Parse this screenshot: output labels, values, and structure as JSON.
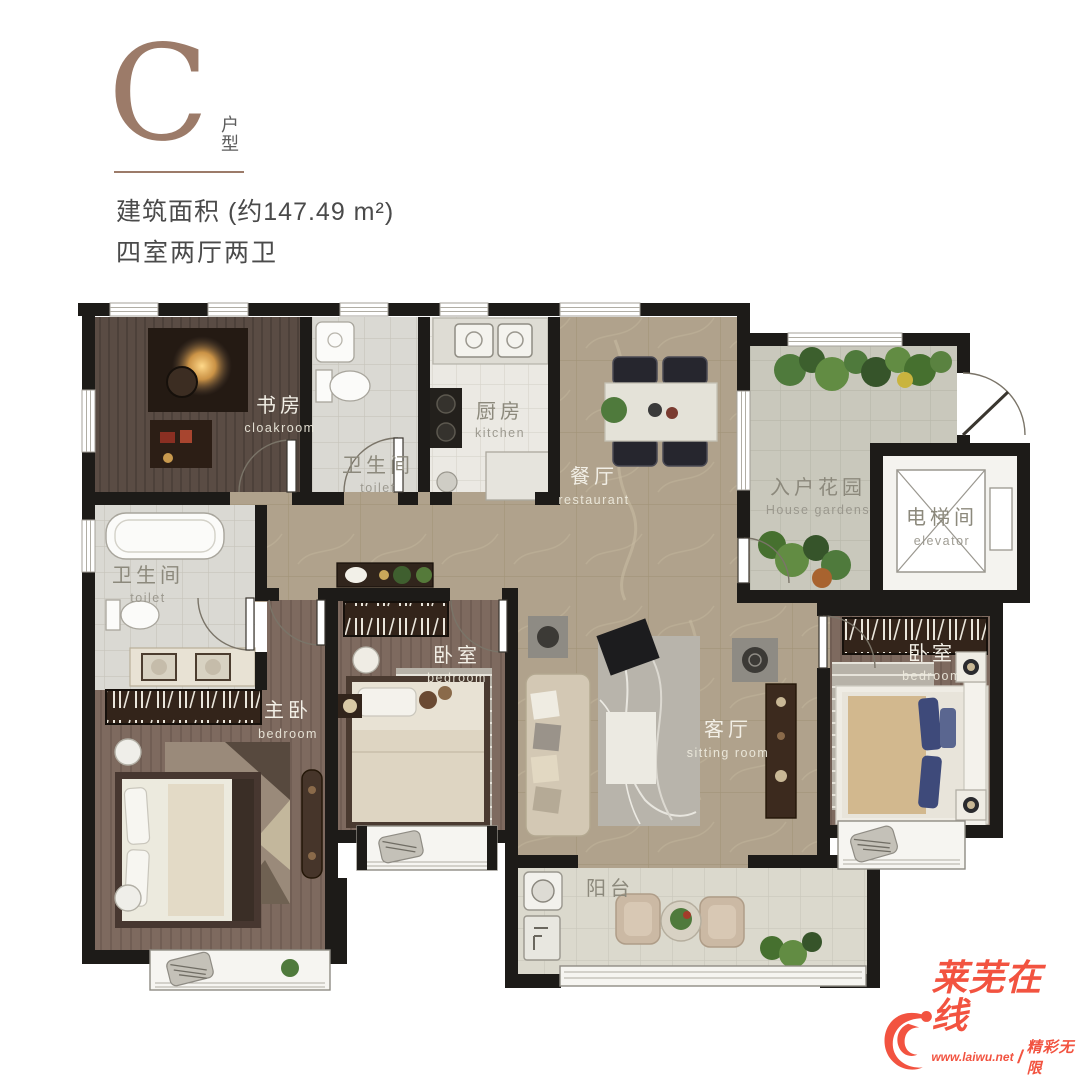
{
  "header": {
    "unit_letter": "C",
    "unit_type_label": "户型",
    "area_text": "建筑面积 (约147.49 m²)",
    "layout_text": "四室两厅两卫"
  },
  "rooms": {
    "study": {
      "zh": "书房",
      "en": "cloakroom"
    },
    "toilet_top": {
      "zh": "卫生间",
      "en": "toilet"
    },
    "kitchen": {
      "zh": "厨房",
      "en": "kitchen"
    },
    "dining": {
      "zh": "餐厅",
      "en": "restaurant"
    },
    "garden": {
      "zh": "入户花园",
      "en": "House gardens"
    },
    "elevator": {
      "zh": "电梯间",
      "en": "elevator"
    },
    "toilet_left": {
      "zh": "卫生间",
      "en": "toilet"
    },
    "master": {
      "zh": "主卧",
      "en": "bedroom"
    },
    "bedroom_mid": {
      "zh": "卧室",
      "en": "bedroom"
    },
    "living": {
      "zh": "客厅",
      "en": "sitting room"
    },
    "bedroom_right": {
      "zh": "卧室",
      "en": "bedroom"
    },
    "balcony": {
      "zh": "阳台",
      "en": ""
    }
  },
  "watermark": {
    "brand": "莱芜在线",
    "url": "www.laiwu.net",
    "slogan": "精彩无限"
  },
  "colors": {
    "wall": "#1d1b18",
    "marble_floor": "#b0a28c",
    "wood_study": "#5a4c44",
    "wood_bedroom": "#7e6a5f",
    "tile_bath": "#dad9d3",
    "tile_garden": "#c9c8bc",
    "header_accent": "#9c7b69",
    "watermark_red": "#f25340"
  }
}
